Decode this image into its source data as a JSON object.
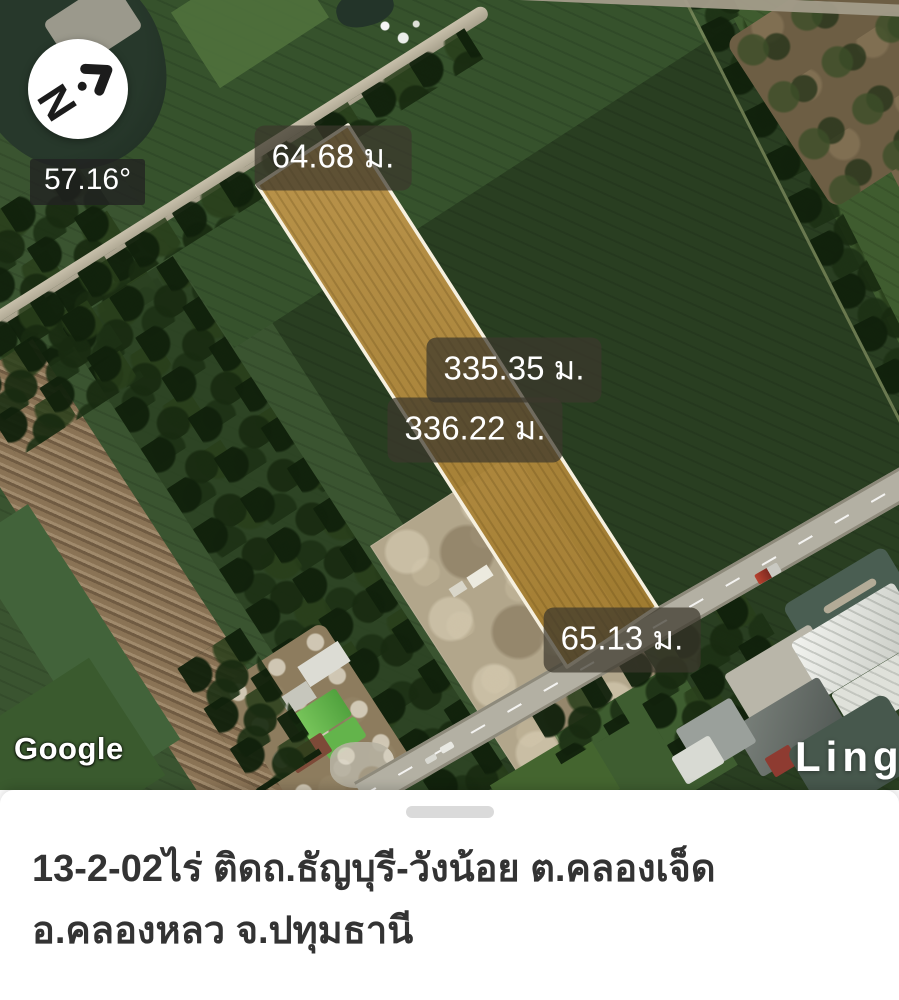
{
  "map": {
    "provider": "Google",
    "watermark_right": "Ling",
    "compass": {
      "letter": "N",
      "bearing": "57.16°"
    },
    "measurements": {
      "top": "64.68 ม.",
      "right": "335.35 ม.",
      "left": "336.22 ม.",
      "bottom": "65.13 ม."
    },
    "colors": {
      "plot_fill": "#b1893d",
      "plot_border": "#f6f0df",
      "label_background": "rgba(59,55,45,0.72)",
      "field_green_dark": "#293e21",
      "field_green_mid": "#3a5430",
      "dirt_tan": "#b2a68b",
      "road_gray": "#b3b0a3"
    }
  },
  "sheet": {
    "title_line1": "13-2-02ไร่ ติดถ.ธัญบุรี-วังน้อย ต.คลองเจ็ด",
    "title_line2": "อ.คลองหลว จ.ปทุมธานี"
  }
}
